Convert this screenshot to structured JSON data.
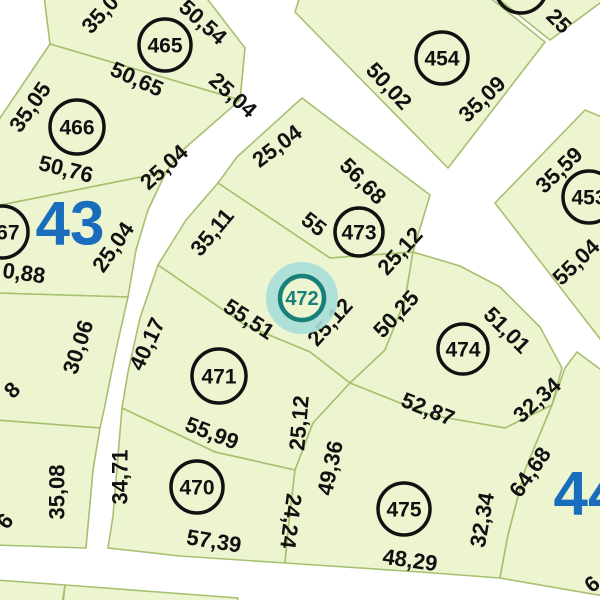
{
  "map": {
    "title": "cadastral-parcel-map",
    "colors": {
      "background": "#ffffff",
      "parcel_fill": "#ecf5d0",
      "parcel_stroke": "#a6c070",
      "label_color": "#111111",
      "marker_stroke": "#111111",
      "block_number_color": "#1a6cbd",
      "selected_ring_color": "#17807a",
      "selected_glow_color": "#a9ded7",
      "selected_text_color": "#17807a"
    },
    "selected_parcel": "472",
    "parcels": [
      {
        "id": "465",
        "points": "44,-4 205,-4 245,48 240,100 50,44"
      },
      {
        "id": "466",
        "points": "50,44 240,100 185,148 166,172 -4,206 -4,124"
      },
      {
        "id": "467",
        "points": "166,172 148,210 136,250 128,297 -4,293 -4,206"
      },
      {
        "id": "468",
        "points": "128,297 116,350 104,410 100,428 -4,420 -4,293"
      },
      {
        "id": "469",
        "points": "100,428 93,470 86,548 -4,545 -4,420"
      },
      {
        "id": "sliver-a",
        "points": "-4,580 65,585 62,604 -4,604"
      },
      {
        "id": "sliver-b",
        "points": "65,585 238,598 237,604 63,604"
      },
      {
        "id": "473",
        "points": "237,157 302,98 430,195 413,252 330,258 218,183"
      },
      {
        "id": "472",
        "points": "218,183 330,258 413,252 405,300 385,350 350,383 310,352 245,325 158,265 186,220"
      },
      {
        "id": "471",
        "points": "158,265 245,325 310,352 350,383 313,423 295,470 215,452 122,408 128,372 140,318"
      },
      {
        "id": "470",
        "points": "122,408 215,452 295,470 288,530 285,563 180,556 108,548 113,516 117,468"
      },
      {
        "id": "474",
        "points": "413,252 460,266 500,287 540,327 562,368 552,405 505,428 430,415 350,383 385,350 405,300"
      },
      {
        "id": "475",
        "points": "350,383 430,415 505,428 552,405 525,470 508,535 500,578 420,572 285,563 288,530 295,470 313,423"
      },
      {
        "id": "block44",
        "points": "577,352 604,372 604,596 500,578 508,535 525,470 552,405 565,368"
      },
      {
        "id": "453",
        "points": "495,203 585,110 604,118 604,344"
      },
      {
        "id": "454",
        "points": "448,168 295,12 300,-4 488,-4 545,42"
      },
      {
        "id": "455",
        "points": "495,-4 550,40 604,0 604,-4"
      }
    ],
    "markers": [
      {
        "number": "465",
        "cx": 165,
        "cy": 45,
        "r": 26
      },
      {
        "number": "466",
        "cx": 77,
        "cy": 127,
        "r": 27
      },
      {
        "number": "467",
        "cx": 2,
        "cy": 232,
        "r": 26
      },
      {
        "number": "454",
        "cx": 442,
        "cy": 58,
        "r": 26
      },
      {
        "number": "455",
        "cx": 521,
        "cy": -13,
        "r": 26
      },
      {
        "number": "453",
        "cx": 589,
        "cy": 197,
        "r": 26
      },
      {
        "number": "473",
        "cx": 359,
        "cy": 232,
        "r": 24
      },
      {
        "number": "471",
        "cx": 219,
        "cy": 376,
        "r": 27
      },
      {
        "number": "470",
        "cx": 197,
        "cy": 487,
        "r": 26
      },
      {
        "number": "474",
        "cx": 463,
        "cy": 349,
        "r": 25
      },
      {
        "number": "475",
        "cx": 404,
        "cy": 509,
        "r": 26
      },
      {
        "number": "472",
        "cx": 302,
        "cy": 298,
        "r": 22,
        "selected": true
      }
    ],
    "block_numbers": [
      {
        "text": "43",
        "x": 70,
        "y": 224
      },
      {
        "text": "44",
        "x": 588,
        "y": 494
      }
    ],
    "dimension_labels": [
      {
        "t": "35,0",
        "x": 100,
        "y": 14,
        "r": -48
      },
      {
        "t": "50,54",
        "x": 203,
        "y": 22,
        "r": 42
      },
      {
        "t": "50,65",
        "x": 137,
        "y": 79,
        "r": 24
      },
      {
        "t": "25,04",
        "x": 233,
        "y": 95,
        "r": 42
      },
      {
        "t": "35,05",
        "x": 30,
        "y": 107,
        "r": -55
      },
      {
        "t": "50,76",
        "x": 66,
        "y": 169,
        "r": 14
      },
      {
        "t": "25,04",
        "x": 164,
        "y": 167,
        "r": -42
      },
      {
        "t": "25,04",
        "x": 113,
        "y": 247,
        "r": -55
      },
      {
        "t": "0,88",
        "x": 24,
        "y": 273,
        "r": 8
      },
      {
        "t": "30,06",
        "x": 78,
        "y": 347,
        "r": -72
      },
      {
        "t": "8",
        "x": 12,
        "y": 390,
        "r": -45
      },
      {
        "t": "35,08",
        "x": 57,
        "y": 492,
        "r": -90
      },
      {
        "t": "6",
        "x": 5,
        "y": 521,
        "r": -50
      },
      {
        "t": "34,71",
        "x": 120,
        "y": 477,
        "r": -90
      },
      {
        "t": "40,17",
        "x": 147,
        "y": 344,
        "r": -65
      },
      {
        "t": "57,39",
        "x": 214,
        "y": 541,
        "r": 9
      },
      {
        "t": "55,99",
        "x": 212,
        "y": 433,
        "r": 21
      },
      {
        "t": "24,24",
        "x": 291,
        "y": 521,
        "r": 97
      },
      {
        "t": "49,36",
        "x": 330,
        "y": 468,
        "r": -78
      },
      {
        "t": "48,29",
        "x": 410,
        "y": 560,
        "r": 8
      },
      {
        "t": "25,12",
        "x": 299,
        "y": 423,
        "r": -85
      },
      {
        "t": "55,51",
        "x": 249,
        "y": 319,
        "r": 33
      },
      {
        "t": "35,11",
        "x": 212,
        "y": 232,
        "r": -50
      },
      {
        "t": "25,04",
        "x": 277,
        "y": 146,
        "r": -37
      },
      {
        "t": "25,12",
        "x": 400,
        "y": 251,
        "r": -48
      },
      {
        "t": "25,12",
        "x": 330,
        "y": 322,
        "r": -48
      },
      {
        "t": "50,25",
        "x": 396,
        "y": 314,
        "r": -47
      },
      {
        "t": "55",
        "x": 314,
        "y": 224,
        "r": 38
      },
      {
        "t": "56,68",
        "x": 363,
        "y": 181,
        "r": 45
      },
      {
        "t": "50,02",
        "x": 389,
        "y": 86,
        "r": 47
      },
      {
        "t": "35,09",
        "x": 482,
        "y": 99,
        "r": -44
      },
      {
        "t": "25",
        "x": 559,
        "y": 21,
        "r": 45
      },
      {
        "t": "35,59",
        "x": 559,
        "y": 170,
        "r": -44
      },
      {
        "t": "55,04",
        "x": 576,
        "y": 262,
        "r": -44
      },
      {
        "t": "51,01",
        "x": 507,
        "y": 330,
        "r": 45
      },
      {
        "t": "52,87",
        "x": 428,
        "y": 409,
        "r": 22
      },
      {
        "t": "32,34",
        "x": 537,
        "y": 400,
        "r": -42
      },
      {
        "t": "64,68",
        "x": 530,
        "y": 472,
        "r": -55
      },
      {
        "t": "32,34",
        "x": 482,
        "y": 520,
        "r": -80
      },
      {
        "t": "6",
        "x": 592,
        "y": 584,
        "r": -40
      }
    ]
  }
}
